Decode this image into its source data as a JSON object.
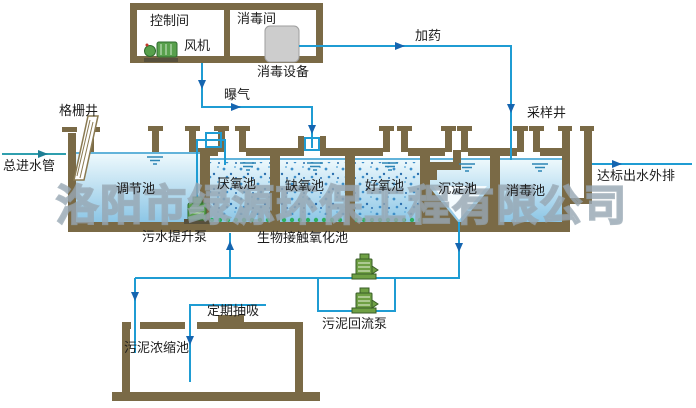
{
  "watermark": "洛阳市绿源环保工程有限公司",
  "building": {
    "control_room_label": "控制间",
    "fan_label": "风机",
    "disinfection_room_label": "消毒间",
    "disinfection_equipment_label": "消毒设备"
  },
  "pipes": {
    "dosing_label": "加药",
    "aeration_label": "曝气",
    "inlet_label": "总进水管",
    "outlet_label": "达标出水外排",
    "periodic_suction_label": "定期抽吸"
  },
  "wells": {
    "grid_well_label": "格栅井",
    "sampling_well_label": "采样井"
  },
  "tanks": {
    "regulation_label": "调节池",
    "anaerobic_label": "厌氧池",
    "anoxic_label": "缺氧池",
    "aerobic_label": "好氧池",
    "sedimentation_label": "沉淀池",
    "disinfection_label": "消毒池",
    "bio_contact_label": "生物接触氧化池",
    "sludge_thickening_label": "污泥浓缩池"
  },
  "pumps": {
    "sewage_lift_label": "污水提升泵",
    "sludge_return_label": "污泥回流泵"
  },
  "colors": {
    "wall": "#7a6a46",
    "pipe": "#1f9cd3",
    "inlet_pipe": "#2f9fae",
    "arrow": "#1565b0",
    "water_top": "#f0fafd",
    "water_bottom": "#8cc6e6",
    "bio_dots": "#3e8fc9",
    "media_green": "#2fae62",
    "pump_green": "#58a04c",
    "equipment_gray": "#cdcdcd",
    "watermark_gray": "#a9b6bf"
  }
}
